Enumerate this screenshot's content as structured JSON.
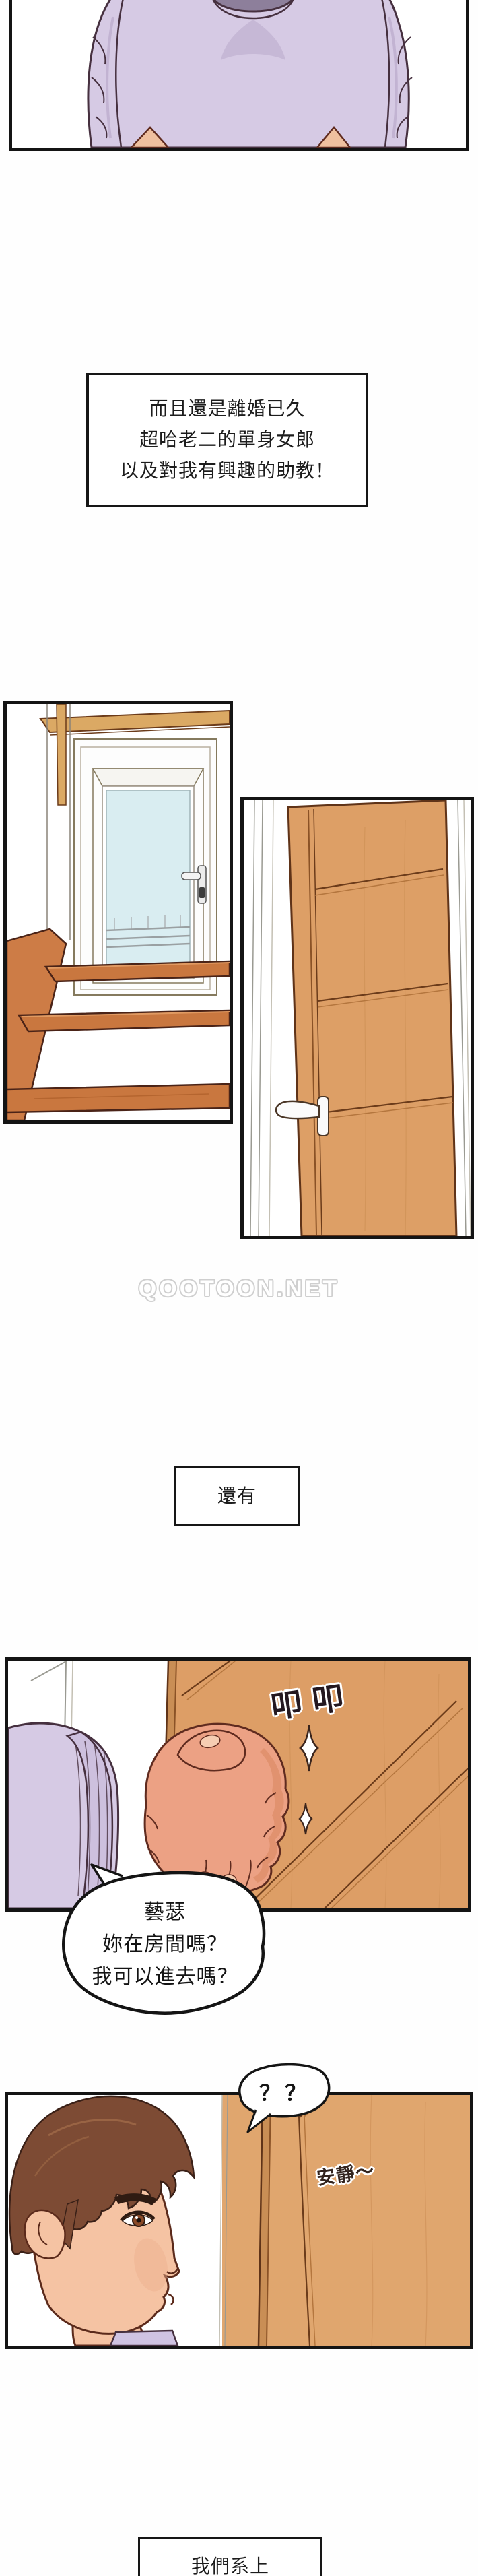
{
  "palette": {
    "panel_border": "#141414",
    "sweater_lavender": "#d6cae4",
    "sleeve_cuff": "#cdc0de",
    "skin_hand": "#eca184",
    "skin_face": "#f5c3a3",
    "hair_brown": "#7d4b34",
    "door_wood": "#dd9f66",
    "door_groove": "#6b3b1a",
    "stair_wood": "#c9773f",
    "glass_blue": "#d9edf1",
    "watermark_outline": "#cfcfcf"
  },
  "illustrations": {
    "panel1": "torso-in-lavender-sweater",
    "panel2": "stairs-and-white-glass-door",
    "panel3": "wooden-room-door",
    "panel4": "fist-knocking-on-door",
    "panel5": "man-profile-facing-door"
  },
  "narrations": {
    "box1_lines": [
      "而且還是離婚已久",
      "超哈老二的單身女郎",
      "以及對我有興趣的助教！"
    ],
    "box2_text": "還有",
    "box3_text": "我們系上"
  },
  "speech": {
    "bubble1_lines": [
      "藝瑟",
      "妳在房間嗎？",
      "我可以進去嗎？"
    ],
    "bubble2_text": "？？"
  },
  "sfx": {
    "knock": "叩叩",
    "quiet": "安靜～"
  },
  "watermark": "QOOTOON.NET"
}
